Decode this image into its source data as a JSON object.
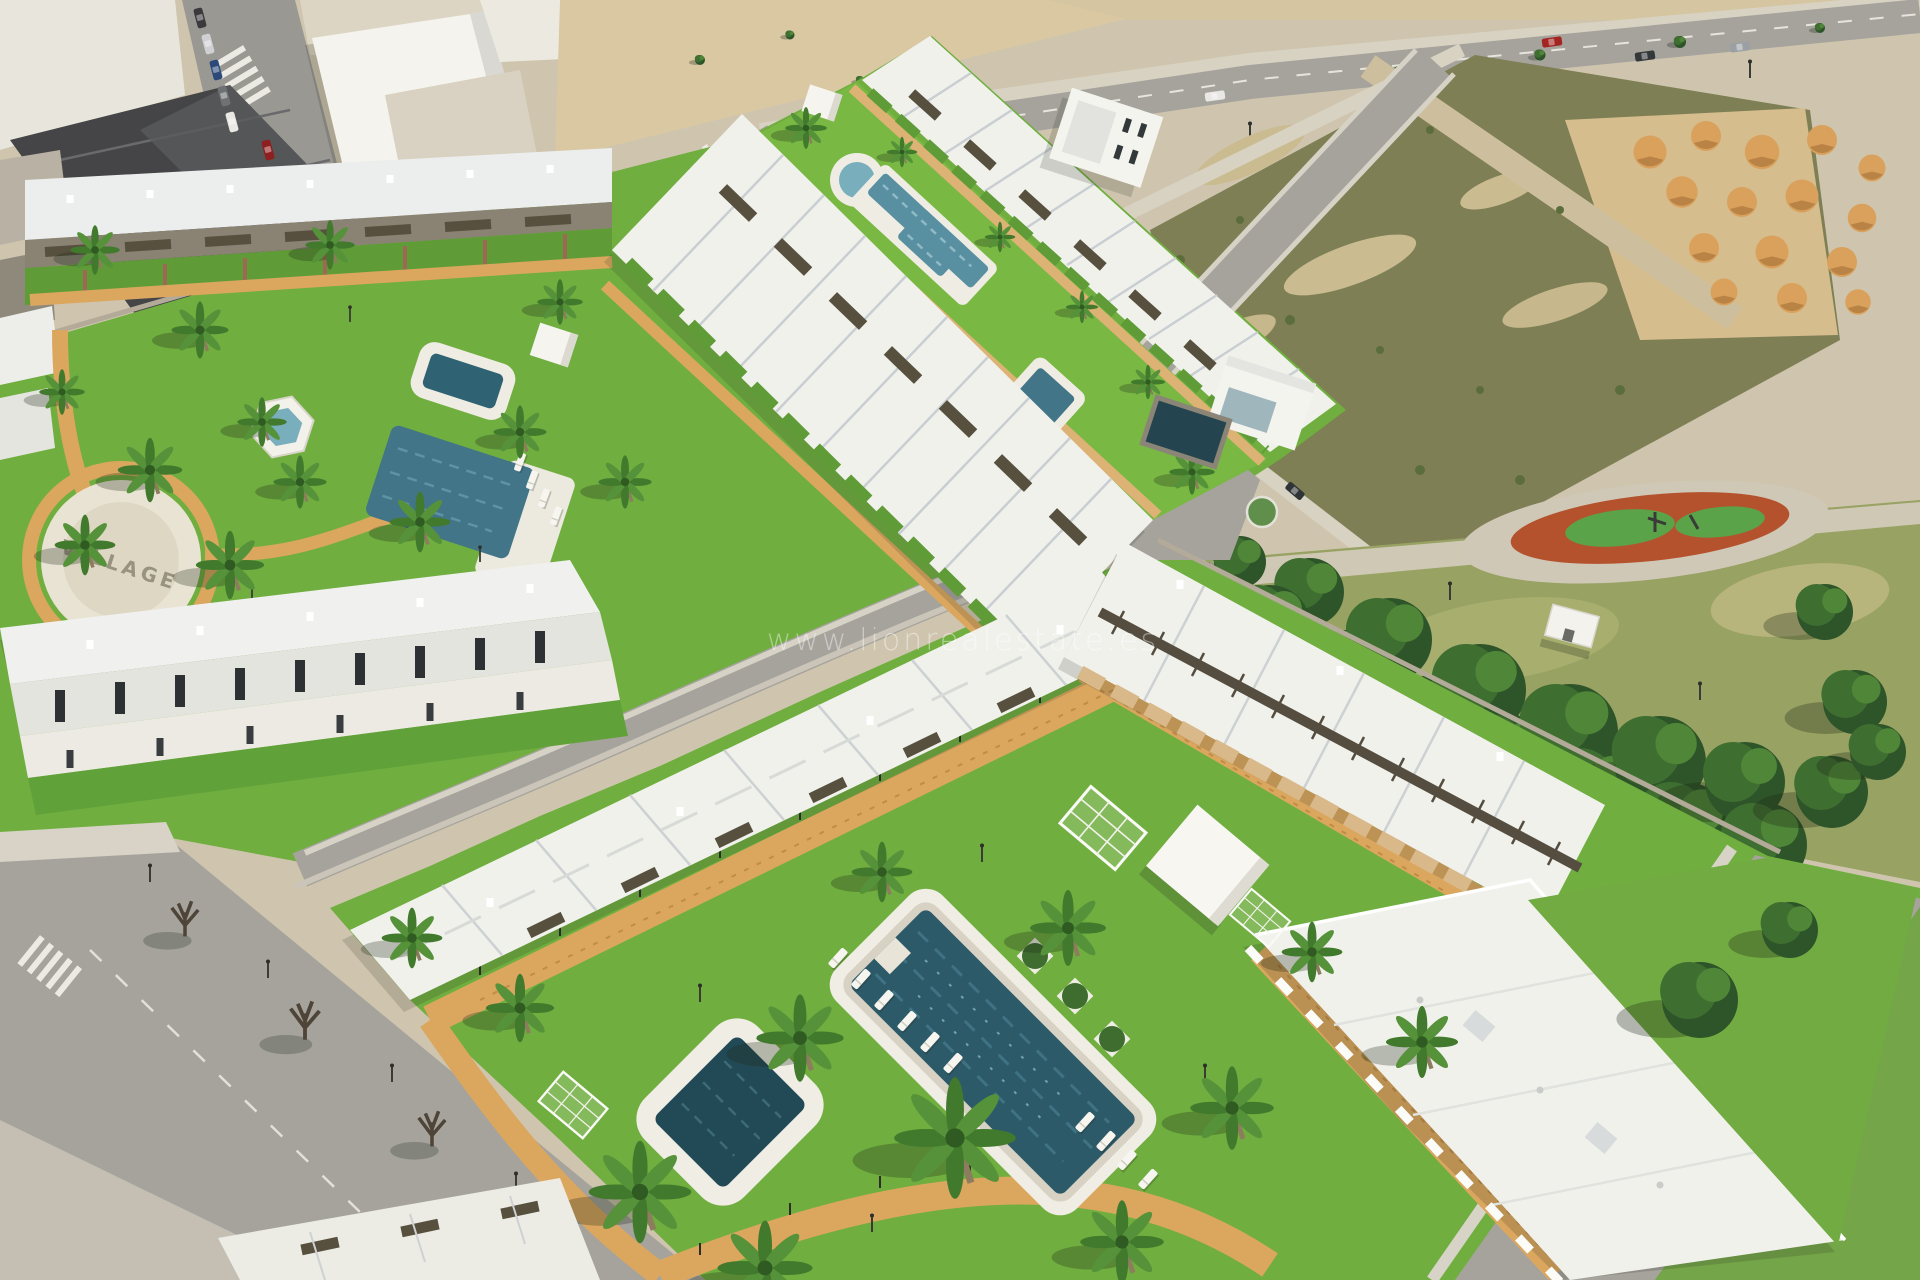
{
  "watermark": {
    "text": "www.lionrealestate.es"
  },
  "plaza_logo": "VILLAGE",
  "palette": {
    "base_sand": "#cfc5ae",
    "lawn": "#6fae3f",
    "lawn_bright": "#79b843",
    "park_grass": "#98a263",
    "field_scrub": "#7e7f55",
    "sand": "#d9c8a2",
    "sand_mound": "#d9a15c",
    "road": "#a5a39c",
    "sidewalk": "#d8d3c6",
    "path_tan": "#dba75f",
    "pool_dark": "#2c5a68",
    "pool_mid": "#417587",
    "pool_light": "#79aebc",
    "building_white": "#f1f1ec",
    "roof_light": "#e9eae6",
    "pergola_brown": "#57503f",
    "tree_green": "#2e5429",
    "playground_red": "#b5522e",
    "playground_green": "#5aa348",
    "wall_stone": "#b3aa99",
    "car_red": "#a32420",
    "watermark_white": "#ffffff"
  }
}
